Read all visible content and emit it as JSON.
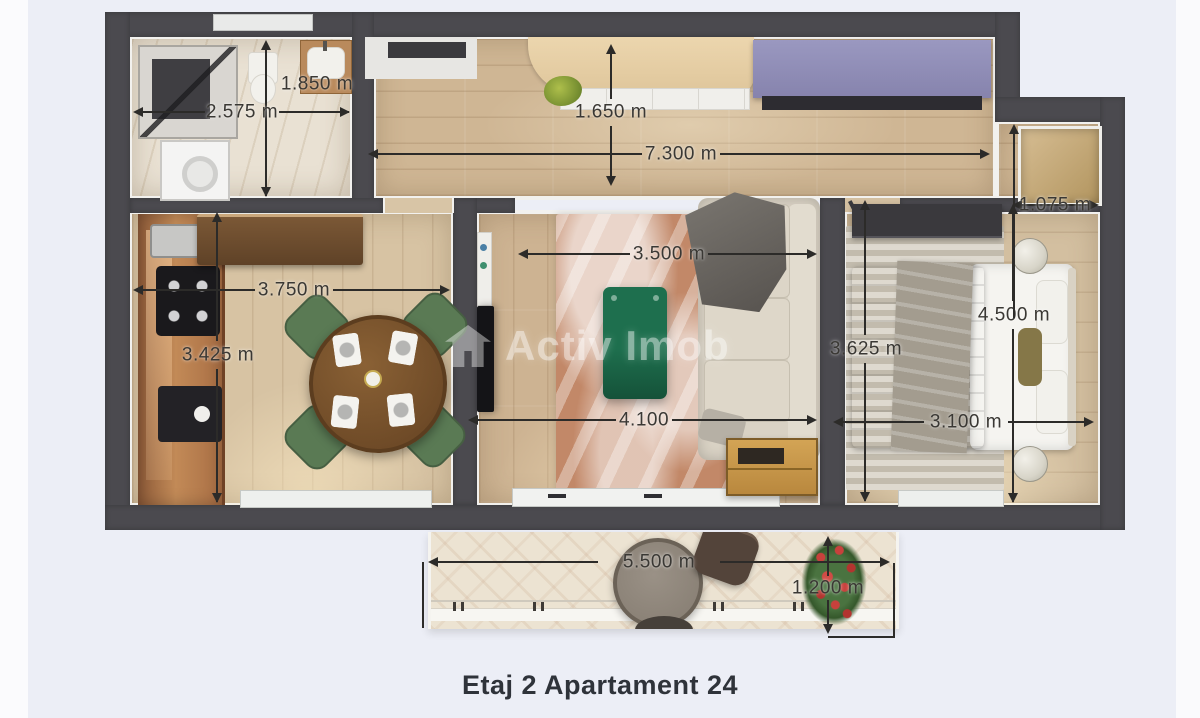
{
  "title": "Etaj 2 Apartament 24",
  "watermark": {
    "brand": "Activ Imob"
  },
  "dimensions": {
    "bathroom": {
      "depth": "1.850 m",
      "width": "2.575 m"
    },
    "hall": {
      "entry_depth": "1.650 m",
      "overall_width": "7.300 m"
    },
    "living_room": {
      "width": "3.500 m",
      "length": "4.100"
    },
    "kitchen": {
      "width": "3.750 m",
      "depth": "3.425 m"
    },
    "bedroom": {
      "depth": "3.625 m",
      "length": "4.500 m",
      "width": "3.100 m"
    },
    "niche": {
      "width": "1.075 m"
    },
    "balcony": {
      "width": "5.500 m",
      "depth": "1.200 m"
    }
  },
  "colors": {
    "background": "#eceef6",
    "walls": "#4b4a4f",
    "sideboard_purple": "#8f8db7",
    "coffee_table_green": "#1e6f4e",
    "dining_chair_green": "#5a7a54",
    "title_text": "#2f333a",
    "dimension_text": "#3a3834"
  }
}
